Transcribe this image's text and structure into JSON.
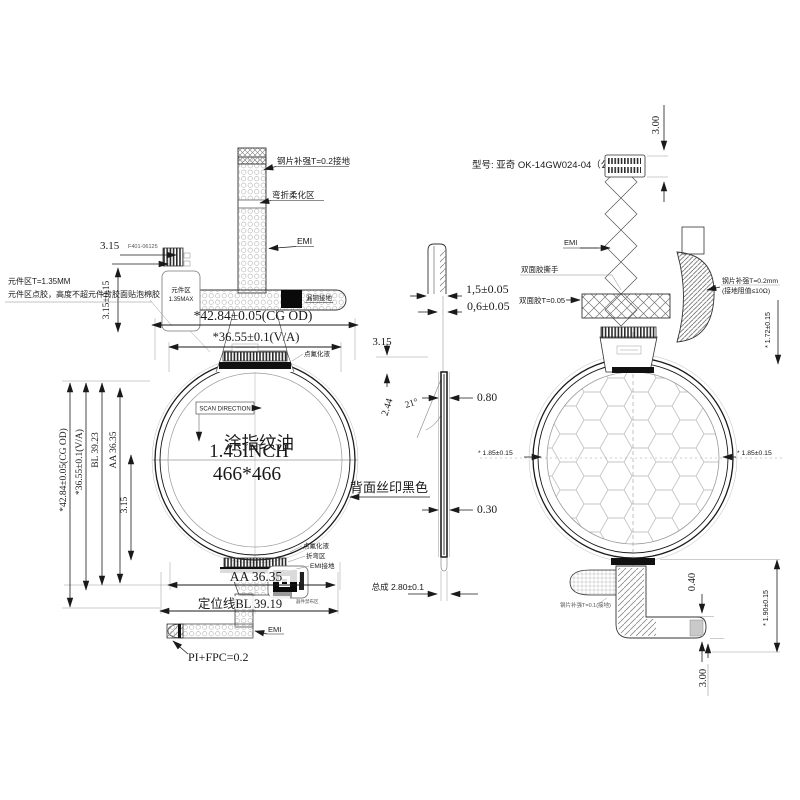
{
  "front": {
    "steel_top": "钢片补强T=0.2接地",
    "bend_zone": "弯折柔化区",
    "emi_top": "EMI",
    "copper_ground": "漏铜接地",
    "dim_315_conn": "3.15",
    "conn_pn": "F401-06125",
    "comp_area1": "元件区",
    "comp_area2": "1.35MAX",
    "note1": "元件区T=1.35MM",
    "note2": "元件区点胶，高度不超元件背胶面贴泡棉胶",
    "dim_315_015": "3.15±0.15",
    "dim_cg_h": "*42.84±0.05(CG OD)",
    "dim_va_h": "*36.55±0.1(V/A)",
    "scan": "SCAN DIRECTION",
    "coat": "涂指纹油",
    "inch": "1.45INCH",
    "res": "466*466",
    "fluoride_top": "点氟化液",
    "fluoride_bot": "点氟化液",
    "bend_bot": "折弯区",
    "emi_gnd": "EMI接地",
    "keepout": "器件禁布区",
    "dim_aa_bot": "AA 36.35",
    "dim_bl_bot": "定位线BL 39.19",
    "emi_bot": "EMI",
    "pi_fpc": "PI+FPC=0.2",
    "dim_cg_v": "*42.84±0.05(CG OD)",
    "dim_va_v": "*36.55±0.1(V/A)",
    "dim_bl_v": "BL 39.23",
    "dim_aa_v": "AA 36.35",
    "dim_315_v": "3.15"
  },
  "side": {
    "dim_15": "1,5±0.05",
    "dim_06": "0,6±0.05",
    "dim_315": "3.15",
    "dim_244": "2.44",
    "dim_21": "21°",
    "dim_080": "0.80",
    "dim_030": "0.30",
    "dim_total": "总成 2.80±0.1"
  },
  "back": {
    "model": "型号: 亚奇 OK-14GW024-04（公差）",
    "emi": "EMI",
    "tape_tab": "双面胶撕手",
    "tape_t": "双面胶T=0.05",
    "steel_r1": "钢片补强T=0.2mm",
    "steel_r2": "(接地阻值≤10Ω)",
    "dim_300_top": "3.00",
    "dim_172": "* 1.72±0.15",
    "dim_185_l": "* 1.85±0.15",
    "dim_185_r": "* 1.85±0.15",
    "silk": "背面丝印黑色",
    "steel_bot": "钢片补强T=0.1(接地)",
    "dim_040": "0.40",
    "dim_300_bot": "3.00",
    "dim_190": "* 1.90±0.15"
  }
}
